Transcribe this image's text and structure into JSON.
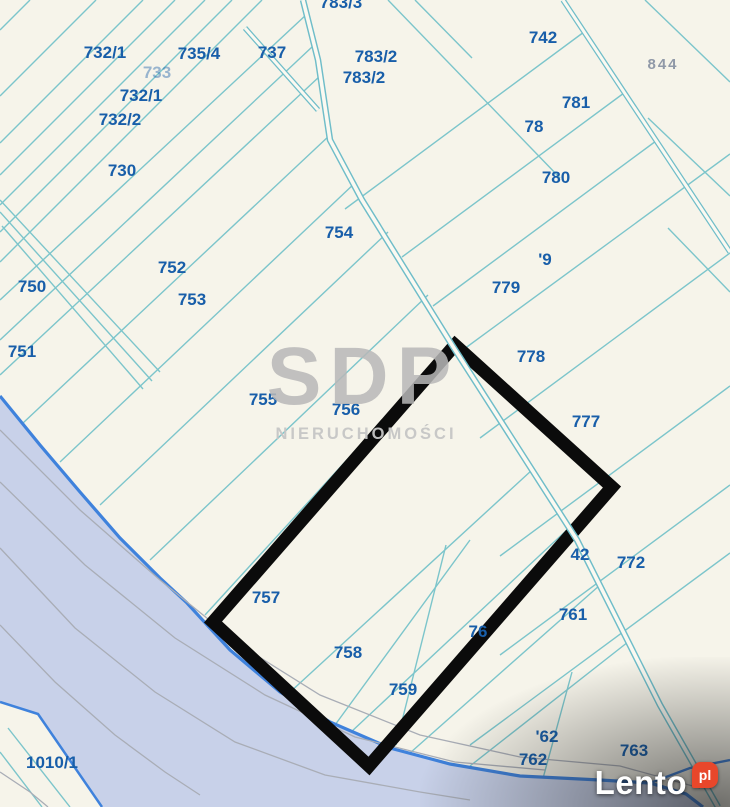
{
  "map": {
    "parcels": [
      {
        "id": "732-1a",
        "label": "732/1"
      },
      {
        "id": "735-4",
        "label": "735/4"
      },
      {
        "id": "737",
        "label": "737"
      },
      {
        "id": "733",
        "label": "733"
      },
      {
        "id": "732-1b",
        "label": "732/1"
      },
      {
        "id": "732-2",
        "label": "732/2"
      },
      {
        "id": "730",
        "label": "730"
      },
      {
        "id": "783-3",
        "label": "783/3"
      },
      {
        "id": "783-2a",
        "label": "783/2"
      },
      {
        "id": "783-2b",
        "label": "783/2"
      },
      {
        "id": "742",
        "label": "742"
      },
      {
        "id": "844",
        "label": "844"
      },
      {
        "id": "781",
        "label": "781"
      },
      {
        "id": "78-partial",
        "label": "78"
      },
      {
        "id": "780",
        "label": "780"
      },
      {
        "id": "754",
        "label": "754"
      },
      {
        "id": "752",
        "label": "752"
      },
      {
        "id": "753",
        "label": "753"
      },
      {
        "id": "750",
        "label": "750"
      },
      {
        "id": "751",
        "label": "751"
      },
      {
        "id": "779-partial",
        "label": "'9"
      },
      {
        "id": "779",
        "label": "779"
      },
      {
        "id": "778",
        "label": "778"
      },
      {
        "id": "777",
        "label": "777"
      },
      {
        "id": "755",
        "label": "755"
      },
      {
        "id": "756",
        "label": "756"
      },
      {
        "id": "742-partial",
        "label": "42"
      },
      {
        "id": "772",
        "label": "772"
      },
      {
        "id": "761",
        "label": "761"
      },
      {
        "id": "757",
        "label": "757"
      },
      {
        "id": "758",
        "label": "758"
      },
      {
        "id": "759",
        "label": "759"
      },
      {
        "id": "76-partial",
        "label": "76"
      },
      {
        "id": "762-partial",
        "label": "'62"
      },
      {
        "id": "762",
        "label": "762"
      },
      {
        "id": "763",
        "label": "763"
      },
      {
        "id": "1010-1",
        "label": "1010/1"
      }
    ],
    "colors": {
      "background": "#f6f4ea",
      "parcel_line": "#7cc5cb",
      "parcel_label": "#185ea9",
      "water_fill": "#c8d1e9",
      "water_border": "#3f82dc",
      "highlight": "#000000"
    }
  },
  "highlight": {
    "shape": "rotated-rectangle",
    "color": "#000000"
  },
  "watermark": {
    "brand": "SDP",
    "subtitle": "NIERUCHOMOŚCI"
  },
  "logo": {
    "brand": "Lento",
    "tld": "pl"
  }
}
